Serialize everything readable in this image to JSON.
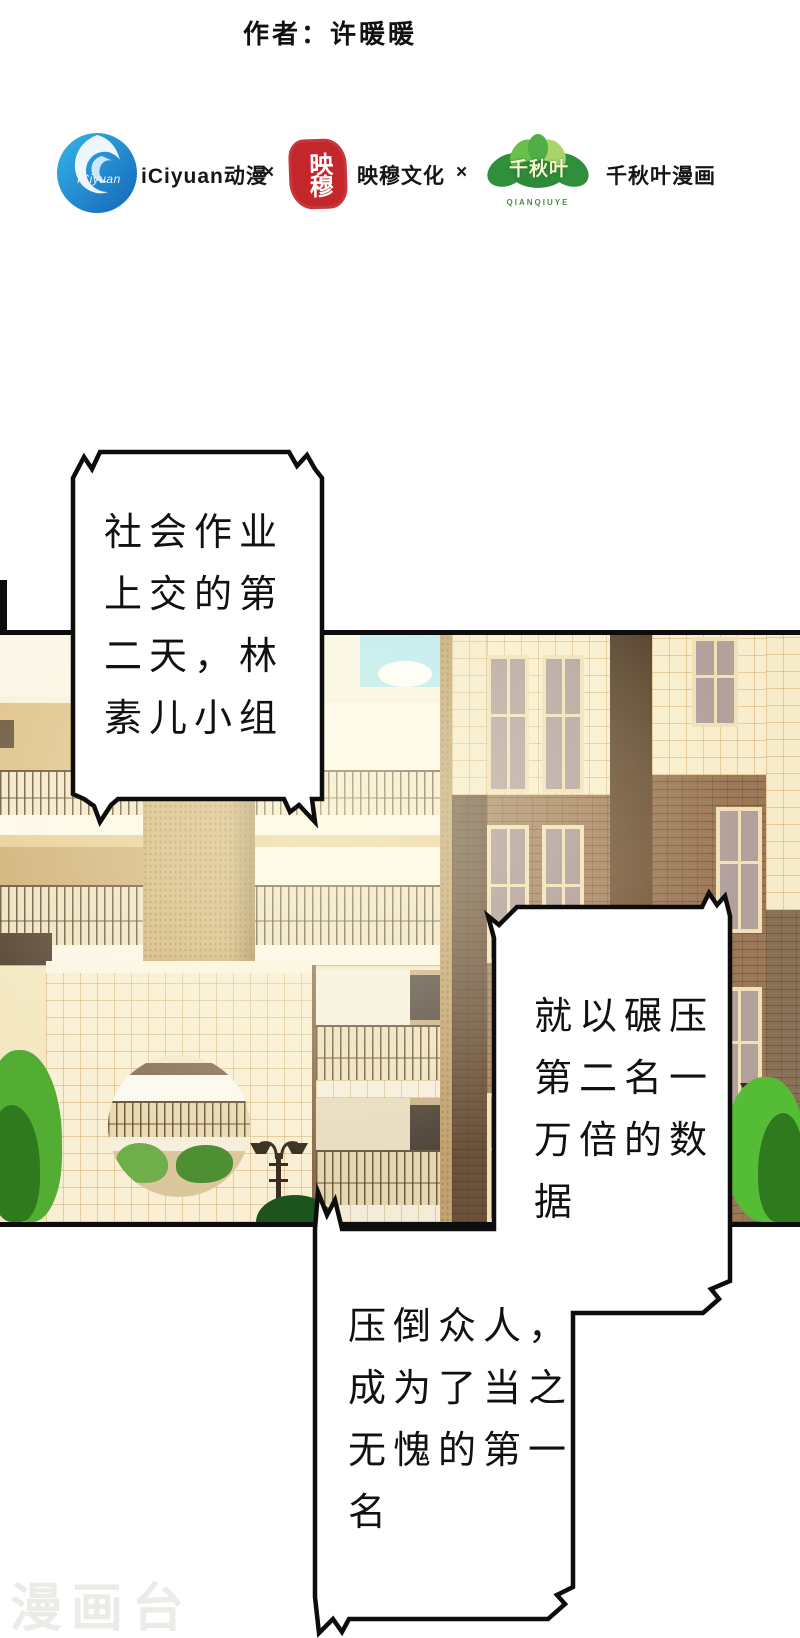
{
  "page": {
    "author_credit": "作者：许暖暖",
    "watermark": "漫画台"
  },
  "publisher_bar": {
    "iciyuan": {
      "logo_text": "iCiyuan",
      "label": "iCiyuan动漫"
    },
    "separator1": "×",
    "yingmu": {
      "seal_chars": "映穆",
      "label": "映穆文化"
    },
    "separator2": "×",
    "qianqiuye": {
      "logo_text": "千秋叶",
      "logo_subtext": "QIANQIUYE",
      "label": "千秋叶漫画"
    }
  },
  "comic": {
    "bubbles": [
      {
        "text": "社会作业\n上交的第\n二天，林\n素儿小组"
      },
      {
        "text": "就以碾压\n第二名一\n万倍的数\n据"
      },
      {
        "text": "压倒众人，\n成为了当之\n无愧的第一\n名"
      }
    ]
  },
  "colors": {
    "brand_blue": "#1e8fd2",
    "seal_red": "#c3272b",
    "leaf_green": "#3a9d3a",
    "ink_black": "#0d0d0d",
    "wall_cream": "#f6ecca",
    "brick_brown": "#a5825f",
    "sky_blue": "#b5eaf3",
    "bush_green": "#4cae2e",
    "watermark_gray": "#ebebe8"
  }
}
